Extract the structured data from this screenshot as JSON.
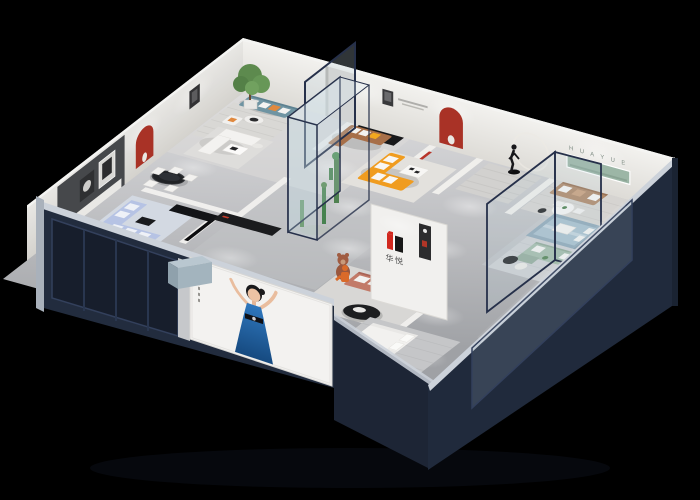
{
  "branding": {
    "logo_text": "华悦",
    "wall_letters": "H U A Y U E"
  },
  "colors": {
    "background": "#000000",
    "outer_wall": "#222c3e",
    "outer_wall_dark": "#1d2535",
    "wall_rim": "#ccd2da",
    "accent_red": "#a93226",
    "logo_red": "#d1281f",
    "logo_black": "#171717",
    "sofa_orange": "#f09c1f",
    "sofa_teal": "#6f94a2",
    "sofa_periwinkle": "#b6c3e4",
    "sofa_salmon": "#c27a68",
    "sofa_green": "#a3bcab",
    "sofa_brown": "#a76f49",
    "sofa_tan": "#b08a6b",
    "pillow_orange": "#e0893f",
    "pillow_yellow": "#f2a71f",
    "bed_blue": "#a9c0cd",
    "shelf_green": "#9cb6a6",
    "plant_green": "#4f8150",
    "dress_blue": "#2563a8",
    "statue_dark": "#17171a",
    "bear_brown": "#9a573d",
    "glass_frame": "#26304a"
  }
}
